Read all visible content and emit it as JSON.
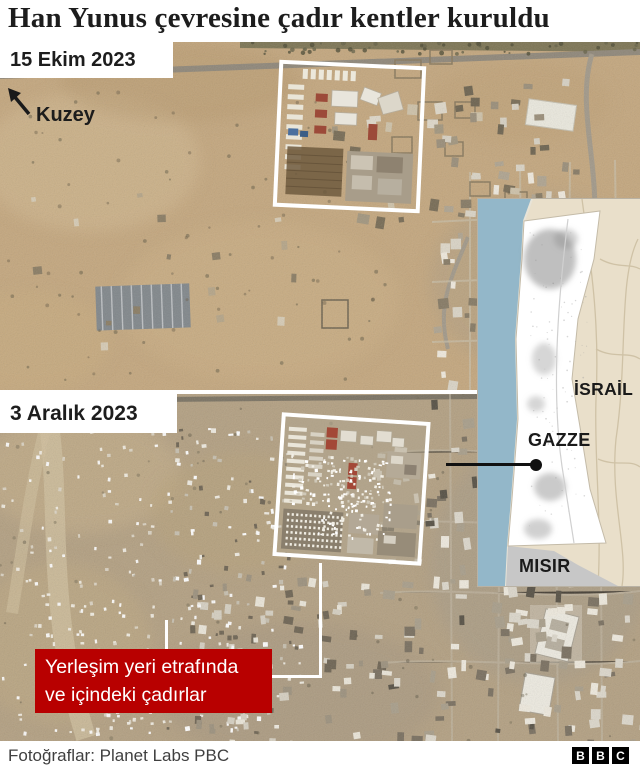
{
  "title": "Han Yunus çevresine çadır kentler kuruldu",
  "compass": {
    "label": "Kuzey"
  },
  "satellite_images": [
    {
      "date_label": "15 Ekim 2023"
    },
    {
      "date_label": "3 Aralık 2023"
    }
  ],
  "callout": {
    "line1": "Yerleşim yeri etrafında",
    "line2": "ve içindeki çadırlar",
    "bg_color": "#b80000",
    "text_color": "#ffffff"
  },
  "inset_map": {
    "labels": {
      "israel": "İSRAİL",
      "gaza": "GAZZE",
      "egypt": "MISIR"
    },
    "colors": {
      "sea": "#93b7c9",
      "israel_land": "#e9dfca",
      "gaza_strip": "#ffffff",
      "egypt_land": "#c7c7c7",
      "marker": "#111111"
    }
  },
  "annotation": {
    "frame_color": "#ffffff"
  },
  "footer": {
    "credit": "Fotoğraflar: Planet Labs PBC",
    "logo_letters": [
      "B",
      "B",
      "C"
    ]
  }
}
